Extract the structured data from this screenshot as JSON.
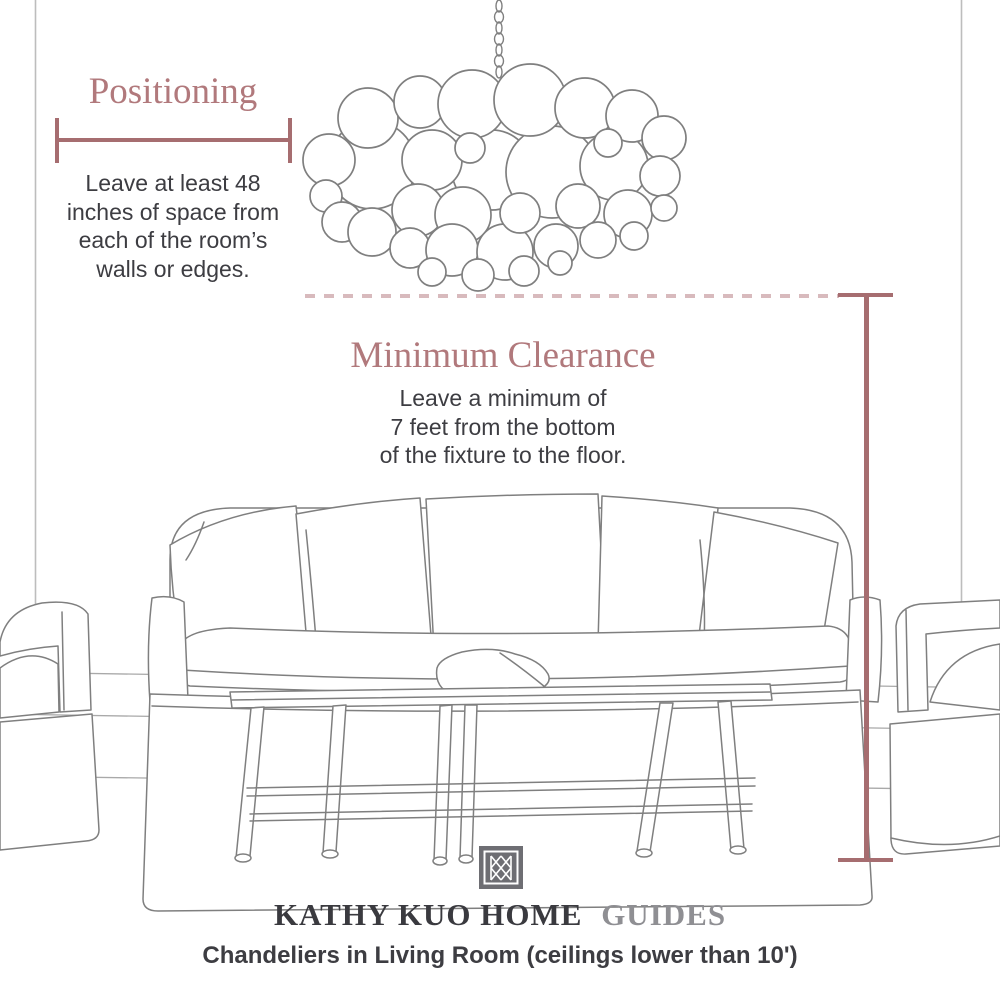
{
  "annotations": {
    "positioning": {
      "title": "Positioning",
      "lines": [
        "Leave at least 48",
        "inches of space from",
        "each of the room’s",
        "walls or edges."
      ]
    },
    "clearance": {
      "title": "Minimum Clearance",
      "lines": [
        "Leave a minimum of",
        "7 feet from the bottom",
        "of the fixture to the floor."
      ]
    }
  },
  "footer": {
    "brand_primary": "KATHY KUO HOME",
    "brand_secondary": "GUIDES",
    "subtitle": "Chandeliers in Living Room (ceilings lower than 10')"
  },
  "icons": {
    "logo": "kathy-kuo-home-monogram-icon"
  },
  "illustration": {
    "chandelier": "bubble-chandelier-line-drawing",
    "sofa": "slipcovered-sofa-line-drawing",
    "coffee_table": "coffee-table-line-drawing",
    "armchair_left": "armchair-line-drawing-left",
    "armchair_right": "armchair-line-drawing-right"
  },
  "colors": {
    "accent_title": "#b1797c",
    "measure_line": "#a66d70",
    "dashed_line": "#d8babd",
    "body_text": "#3d3d42",
    "brand_dark": "#3a3a3f",
    "brand_gray": "#8f8f93",
    "sketch_stroke": "#7f7f7f",
    "logo_square": "#6e6e73"
  }
}
